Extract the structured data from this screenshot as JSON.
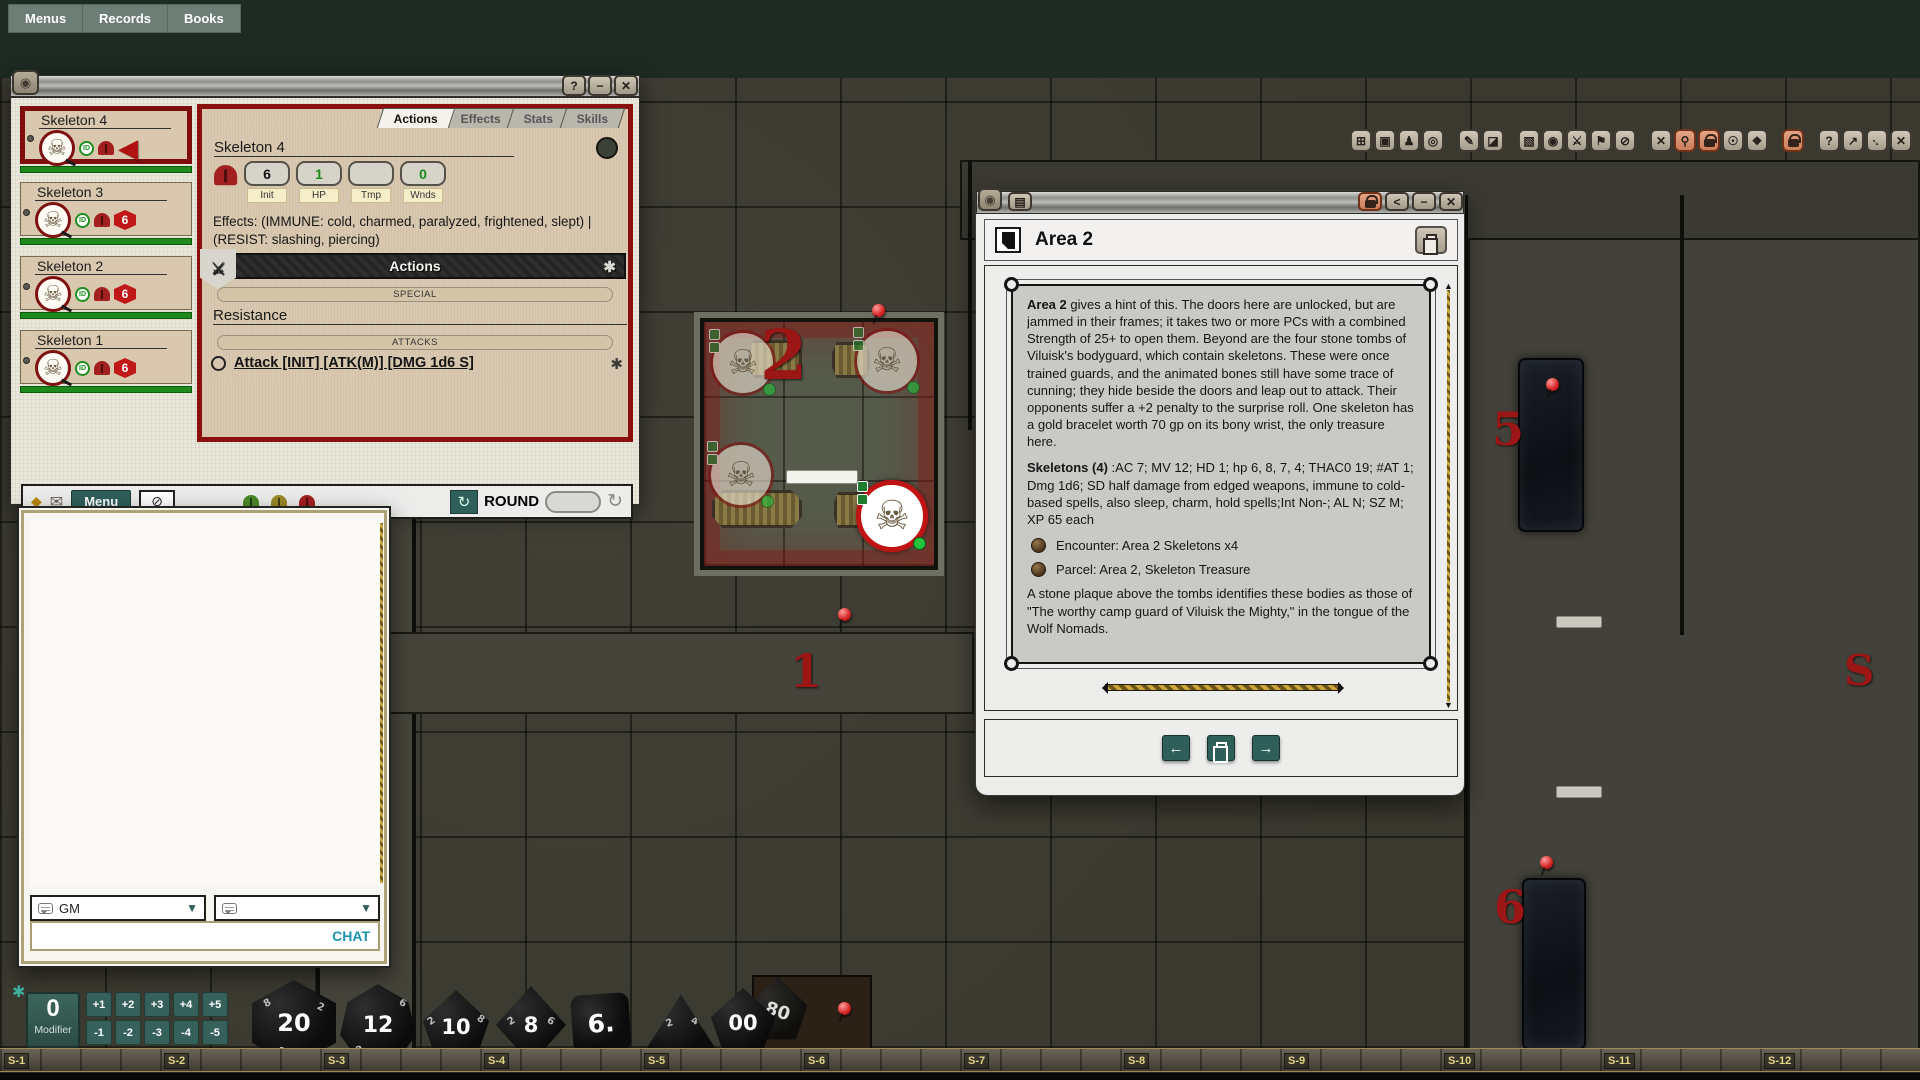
{
  "menubar": {
    "items": [
      "Menus",
      "Records",
      "Books"
    ]
  },
  "icons": {
    "skeleton": "☠",
    "dragon": "◉",
    "gear": "✱",
    "caret": "▼",
    "envelope": "✉",
    "diamond": "◆",
    "eye_off": "⊘",
    "cycle": "↻",
    "refresh": "↻",
    "active_arrow": "◀",
    "book_lines": "▤",
    "share": "<",
    "minimize": "−",
    "close": "✕",
    "help": "?",
    "swords": "⚔",
    "nav_left": "←",
    "nav_right": "→"
  },
  "toolbar": {
    "buttons": [
      {
        "name": "fit-screen",
        "glyph": "⊞"
      },
      {
        "name": "camera",
        "glyph": "▣"
      },
      {
        "name": "person",
        "glyph": "♟"
      },
      {
        "name": "target",
        "glyph": "◎"
      },
      {
        "name": "pencil",
        "glyph": "✎"
      },
      {
        "name": "eraser",
        "glyph": "◪"
      },
      {
        "name": "select-region",
        "glyph": "▧"
      },
      {
        "name": "bullseye",
        "glyph": "◉"
      },
      {
        "name": "crossed-swords",
        "glyph": "⚔"
      },
      {
        "name": "flag",
        "glyph": "⚑"
      },
      {
        "name": "block",
        "glyph": "⊘"
      },
      {
        "name": "token-delete",
        "glyph": "✕"
      },
      {
        "name": "pin",
        "glyph": "⚲"
      },
      {
        "name": "lock-tokens",
        "glyph": ""
      },
      {
        "name": "token-vision",
        "glyph": "☉"
      },
      {
        "name": "move",
        "glyph": "❖"
      },
      {
        "name": "lock-map",
        "glyph": ""
      },
      {
        "name": "help",
        "glyph": "?"
      },
      {
        "name": "shrink",
        "glyph": "↗"
      },
      {
        "name": "resize",
        "glyph": "↔"
      },
      {
        "name": "close",
        "glyph": "✕"
      }
    ]
  },
  "tracker": {
    "win_buttons": [
      "?",
      "−",
      "✕"
    ],
    "entries": [
      {
        "name": "Skeleton 4",
        "id_badge": "ID",
        "badge": ""
      },
      {
        "name": "Skeleton 3",
        "id_badge": "ID",
        "badge": "6"
      },
      {
        "name": "Skeleton 2",
        "id_badge": "ID",
        "badge": "6"
      },
      {
        "name": "Skeleton 1",
        "id_badge": "ID",
        "badge": "6"
      }
    ],
    "tabs": [
      {
        "label": "Actions"
      },
      {
        "label": "Effects"
      },
      {
        "label": "Stats"
      },
      {
        "label": "Skills"
      }
    ],
    "detail": {
      "name": "Skeleton 4",
      "stats": [
        {
          "value": "6",
          "label": "Init"
        },
        {
          "value": "1",
          "label": "HP"
        },
        {
          "value": "",
          "label": "Tmp"
        },
        {
          "value": "0",
          "label": "Wnds"
        }
      ],
      "effects": "Effects: (IMMUNE: cold, charmed, paralyzed, frightened, slept) | (RESIST: slashing, piercing)",
      "actions_header": "Actions",
      "special_button": "SPECIAL",
      "resistance_label": "Resistance",
      "attacks_button": "ATTACKS",
      "attack_line": "Attack [INIT] [ATK(M)] [DMG 1d6 S]"
    },
    "footer": {
      "menu": "Menu",
      "round": "ROUND"
    }
  },
  "chat": {
    "channel_selected": "GM",
    "channel2": "",
    "send_label": "CHAT"
  },
  "modifier": {
    "value": "0",
    "label": "Modifier",
    "buttons": [
      "+1",
      "+2",
      "+3",
      "+4",
      "+5",
      "-1",
      "-2",
      "-3",
      "-4",
      "-5"
    ]
  },
  "dice": {
    "d20": "20",
    "d12": "12",
    "d10": "10",
    "d8": "8",
    "d6": "6.",
    "d100_front": "00",
    "d100_back": "80",
    "d20_small": [
      "8",
      "2",
      "14"
    ],
    "d12_small": [
      "6",
      "2"
    ],
    "d10_small": [
      "2",
      "8"
    ],
    "d8_small": [
      "2",
      "6"
    ],
    "d4_small": [
      "2",
      "4"
    ]
  },
  "ruler": {
    "labels": [
      "S-1",
      "S-2",
      "S-3",
      "S-4",
      "S-5",
      "S-6",
      "S-7",
      "S-8",
      "S-9",
      "S-10",
      "S-11",
      "S-12"
    ]
  },
  "map": {
    "numbers": [
      {
        "text": "2"
      },
      {
        "text": "1"
      },
      {
        "text": "5"
      },
      {
        "text": "6"
      },
      {
        "text": "S"
      }
    ]
  },
  "area2": {
    "title": "Area 2",
    "p1_lead": "Area 2",
    "p1_rest": " gives a hint of this. The doors here are unlocked, but are jammed in their frames; it takes two or more PCs with a combined Strength of 25+ to open them. Beyond are the four stone tombs of Viluisk's bodyguard, which contain skeletons. These were once trained guards, and the animated bones still have some trace of cunning; they hide beside the doors and leap out to attack. Their opponents suffer a +2 penalty to the surprise roll. One skeleton has a gold bracelet worth 70 gp on its bony wrist, the only treasure here.",
    "p2_lead": "Skeletons (4)",
    "p2_rest": " :AC 7; MV 12; HD 1; hp 6, 8, 7, 4; THAC0 19; #AT 1; Dmg 1d6; SD half damage from edged weapons, immune to cold-based spells, also sleep, charm, hold spells;Int Non-; AL N; SZ M; XP 65 each",
    "links": [
      {
        "label": "Encounter: Area 2 Skeletons x4"
      },
      {
        "label": "Parcel: Area 2, Skeleton Treasure"
      }
    ],
    "p3": "A stone plaque above the tombs identifies these bodies as those of \"The worthy camp guard of Viluisk the Mighty,\" in the tongue of the Wolf Nomads."
  }
}
